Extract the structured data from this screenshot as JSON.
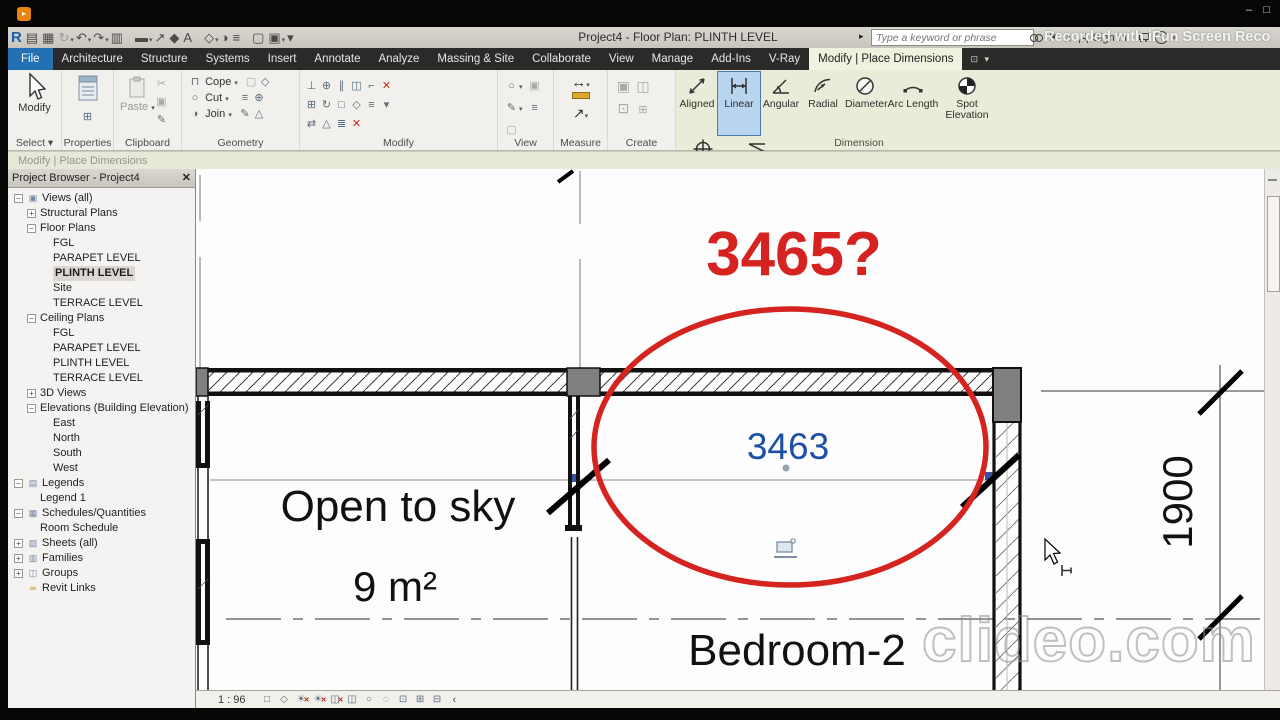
{
  "window": {
    "title": "Project4 - Floor Plan: PLINTH LEVEL",
    "minimize": "–",
    "maximize": "□",
    "recorder_watermark": "Recorded with iFun Screen Reco",
    "clideo_watermark": "clideo.com"
  },
  "search": {
    "placeholder": "Type a keyword or phrase"
  },
  "signin_label": "Sign In",
  "qat": [
    {
      "name": "revit-logo",
      "glyph": "R",
      "cls": "qR"
    },
    {
      "name": "open-icon",
      "glyph": "▤"
    },
    {
      "name": "save-icon",
      "glyph": "▦"
    },
    {
      "name": "sync-icon",
      "glyph": "↻",
      "cls": "qgray",
      "caret": true
    },
    {
      "name": "undo-icon",
      "glyph": "↶",
      "caret": true
    },
    {
      "name": "redo-icon",
      "glyph": "↷",
      "caret": true
    },
    {
      "name": "print-icon",
      "glyph": "▥"
    },
    {
      "name": "sep"
    },
    {
      "name": "measure-icon",
      "glyph": "▬",
      "caret": true
    },
    {
      "name": "aligned-dimension-icon",
      "glyph": "↗"
    },
    {
      "name": "tag-icon",
      "glyph": "◆"
    },
    {
      "name": "text-icon",
      "glyph": "A"
    },
    {
      "name": "sep"
    },
    {
      "name": "default-3d-view-icon",
      "glyph": "◇",
      "caret": true
    },
    {
      "name": "section-icon",
      "glyph": "◑"
    },
    {
      "name": "thin-lines-icon",
      "glyph": "≡"
    },
    {
      "name": "sep"
    },
    {
      "name": "close-hidden-windows-icon",
      "glyph": "▢"
    },
    {
      "name": "switch-windows-icon",
      "glyph": "▣",
      "caret": true
    },
    {
      "name": "customize-qat-icon",
      "glyph": "▾"
    }
  ],
  "tabs": [
    {
      "label": "File",
      "state": "file"
    },
    {
      "label": "Architecture"
    },
    {
      "label": "Structure"
    },
    {
      "label": "Systems"
    },
    {
      "label": "Insert"
    },
    {
      "label": "Annotate"
    },
    {
      "label": "Analyze"
    },
    {
      "label": "Massing & Site"
    },
    {
      "label": "Collaborate"
    },
    {
      "label": "View"
    },
    {
      "label": "Manage"
    },
    {
      "label": "Add-Ins"
    },
    {
      "label": "V-Ray"
    },
    {
      "label": "Modify | Place Dimensions",
      "state": "active"
    }
  ],
  "ribbon": {
    "select": {
      "button": "Modify",
      "label": "Select ▾"
    },
    "properties": {
      "label": "Properties"
    },
    "clipboard": {
      "label": "Clipboard",
      "paste": "Paste"
    },
    "geometry": {
      "label": "Geometry",
      "cope": "Cope",
      "cut": "Cut",
      "join": "Join"
    },
    "modify": {
      "label": "Modify"
    },
    "view": {
      "label": "View"
    },
    "measure": {
      "label": "Measure"
    },
    "create": {
      "label": "Create"
    },
    "dimension": {
      "label": "Dimension",
      "buttons": [
        {
          "label": "Aligned",
          "icon": "aligned",
          "selected": false
        },
        {
          "label": "Linear",
          "icon": "linear",
          "selected": true
        },
        {
          "label": "Angular",
          "icon": "angular",
          "selected": false
        },
        {
          "label": "Radial",
          "icon": "radial",
          "selected": false
        },
        {
          "label": "Diameter",
          "icon": "diameter",
          "selected": false
        },
        {
          "label": "Arc Length",
          "icon": "arclength",
          "selected": false
        },
        {
          "label": "Spot Elevation",
          "icon": "spotelev",
          "selected": false
        },
        {
          "label": "Spot Coordinate",
          "icon": "spotcoord",
          "selected": false
        },
        {
          "label": "Spot Slope",
          "icon": "spotslope",
          "selected": false
        }
      ]
    }
  },
  "options_bar": {
    "label": "Modify | Place Dimensions"
  },
  "browser": {
    "title": "Project Browser - Project4",
    "close": "✕",
    "items": [
      {
        "label": "Views (all)",
        "level": 0,
        "exp": "minus",
        "icon": "views"
      },
      {
        "label": "Structural Plans",
        "level": 1,
        "exp": "plus"
      },
      {
        "label": "Floor Plans",
        "level": 1,
        "exp": "minus"
      },
      {
        "label": "FGL",
        "level": 2
      },
      {
        "label": "PARAPET LEVEL",
        "level": 2
      },
      {
        "label": "PLINTH LEVEL",
        "level": 2,
        "selected": true
      },
      {
        "label": "Site",
        "level": 2
      },
      {
        "label": "TERRACE LEVEL",
        "level": 2
      },
      {
        "label": "Ceiling Plans",
        "level": 1,
        "exp": "minus"
      },
      {
        "label": "FGL",
        "level": 2
      },
      {
        "label": "PARAPET LEVEL",
        "level": 2
      },
      {
        "label": "PLINTH LEVEL",
        "level": 2
      },
      {
        "label": "TERRACE LEVEL",
        "level": 2
      },
      {
        "label": "3D Views",
        "level": 1,
        "exp": "plus"
      },
      {
        "label": "Elevations (Building Elevation)",
        "level": 1,
        "exp": "minus"
      },
      {
        "label": "East",
        "level": 2
      },
      {
        "label": "North",
        "level": 2
      },
      {
        "label": "South",
        "level": 2
      },
      {
        "label": "West",
        "level": 2
      },
      {
        "label": "Legends",
        "level": 0,
        "exp": "minus",
        "icon": "legends"
      },
      {
        "label": "Legend 1",
        "level": 1
      },
      {
        "label": "Schedules/Quantities",
        "level": 0,
        "exp": "minus",
        "icon": "schedules"
      },
      {
        "label": "Room Schedule",
        "level": 1
      },
      {
        "label": "Sheets (all)",
        "level": 0,
        "exp": "plus",
        "icon": "sheets"
      },
      {
        "label": "Families",
        "level": 0,
        "exp": "plus",
        "icon": "families"
      },
      {
        "label": "Groups",
        "level": 0,
        "exp": "plus",
        "icon": "groups"
      },
      {
        "label": "Revit Links",
        "level": 0,
        "icon": "links"
      }
    ]
  },
  "canvas": {
    "annotation_query": "3465?",
    "dimension_value": "3463",
    "room1_label": "Open to sky",
    "room1_area": "9 m²",
    "room2_label": "Bedroom-2",
    "dimension_right": "1900"
  },
  "statusbar": {
    "scale": "1 : 96",
    "collapse": "‹",
    "icons": [
      {
        "name": "show-crop-region-icon",
        "glyph": "□"
      },
      {
        "name": "visual-style-icon",
        "glyph": "◇"
      },
      {
        "name": "sun-path-icon",
        "glyph": "☀",
        "badge": "✕"
      },
      {
        "name": "shadows-icon",
        "glyph": "☀",
        "badge": "✕"
      },
      {
        "name": "crop-view-icon",
        "glyph": "◫",
        "badge": "✕"
      },
      {
        "name": "crop-region-visible-icon",
        "glyph": "◫"
      },
      {
        "name": "reveal-hidden-elements-icon",
        "glyph": "○"
      },
      {
        "name": "temporary-hide-isolate-icon",
        "glyph": "◌"
      },
      {
        "name": "reveal-constraints-icon",
        "glyph": "⊡"
      },
      {
        "name": "worksharing-display-icon",
        "glyph": "⊞"
      },
      {
        "name": "unlocked-view-icon",
        "glyph": "⊟"
      }
    ]
  },
  "colors": {
    "annotation_red": "#d5231f",
    "dimension_blue": "#1d50a5",
    "contextual_green": "#e9ecd9",
    "file_tab_blue": "#2470b4",
    "selected_tool_blue": "#b9d4ee"
  }
}
